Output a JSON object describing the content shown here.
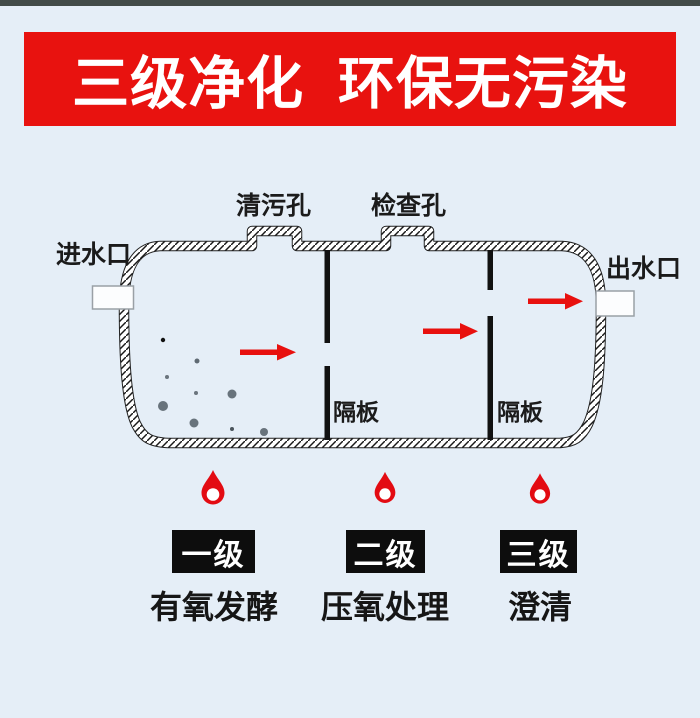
{
  "colors": {
    "background": "#e5eef7",
    "top_strip": "#424b48",
    "banner_red": "#e8120f",
    "arrow_red": "#e8100e",
    "drop_red": "#e30b12",
    "ink": "#1b1b1b",
    "dot_gray": "#68737c"
  },
  "banner": {
    "text": "三级净化  环保无污染"
  },
  "tank": {
    "inlet_label": "进水口",
    "outlet_label": "出水口",
    "cleanout_label": "清污孔",
    "inspection_label": "检查孔",
    "baffle1_label": "隔板",
    "baffle2_label": "隔板"
  },
  "stages": [
    {
      "badge": "一级",
      "caption": "有氧发酵"
    },
    {
      "badge": "二级",
      "caption": "压氧处理"
    },
    {
      "badge": "三级",
      "caption": "澄清"
    }
  ]
}
